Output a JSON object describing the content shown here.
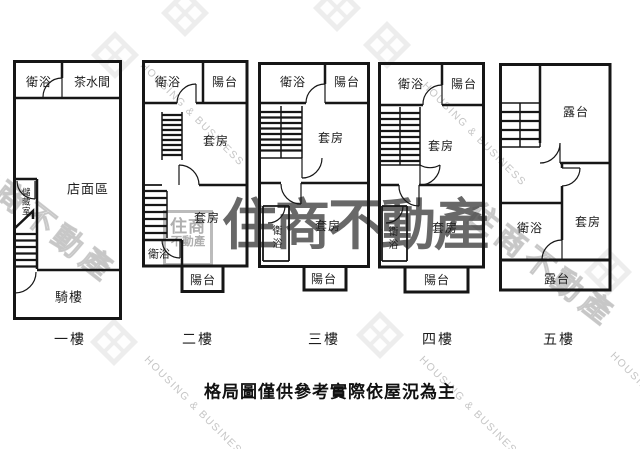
{
  "brand": {
    "name_cjk": "住商不動產",
    "name_en": "HOUSING & BUSINESS",
    "logo_line1": "住商",
    "logo_line2": "不動產"
  },
  "disclaimer": "格局圖僅供參考實際依屋況為主",
  "floors": [
    {
      "label": "一樓",
      "rooms": {
        "bathroom": "衛浴",
        "pantry": "茶水間",
        "storefront": "店面區",
        "storage": "儲藏室",
        "arcade": "騎樓"
      }
    },
    {
      "label": "二樓",
      "rooms": {
        "bathroom_top": "衛浴",
        "balcony_top": "陽台",
        "suite_upper": "套房",
        "suite_lower": "套房",
        "bathroom_bottom": "衛浴",
        "balcony_bottom": "陽台"
      }
    },
    {
      "label": "三樓",
      "rooms": {
        "bathroom_top": "衛浴",
        "balcony_top": "陽台",
        "suite_upper": "套房",
        "suite_lower": "套房",
        "bathroom_bottom": "衛浴",
        "balcony_bottom": "陽台"
      }
    },
    {
      "label": "四樓",
      "rooms": {
        "bathroom_top": "衛浴",
        "balcony_top": "陽台",
        "suite_upper": "套房",
        "suite_lower": "套房",
        "bathroom_bottom": "衛浴",
        "balcony_bottom": "陽台"
      }
    },
    {
      "label": "五樓",
      "rooms": {
        "terrace_top": "露台",
        "bathroom": "衛浴",
        "suite": "套房",
        "terrace_bottom": "露台"
      }
    }
  ]
}
